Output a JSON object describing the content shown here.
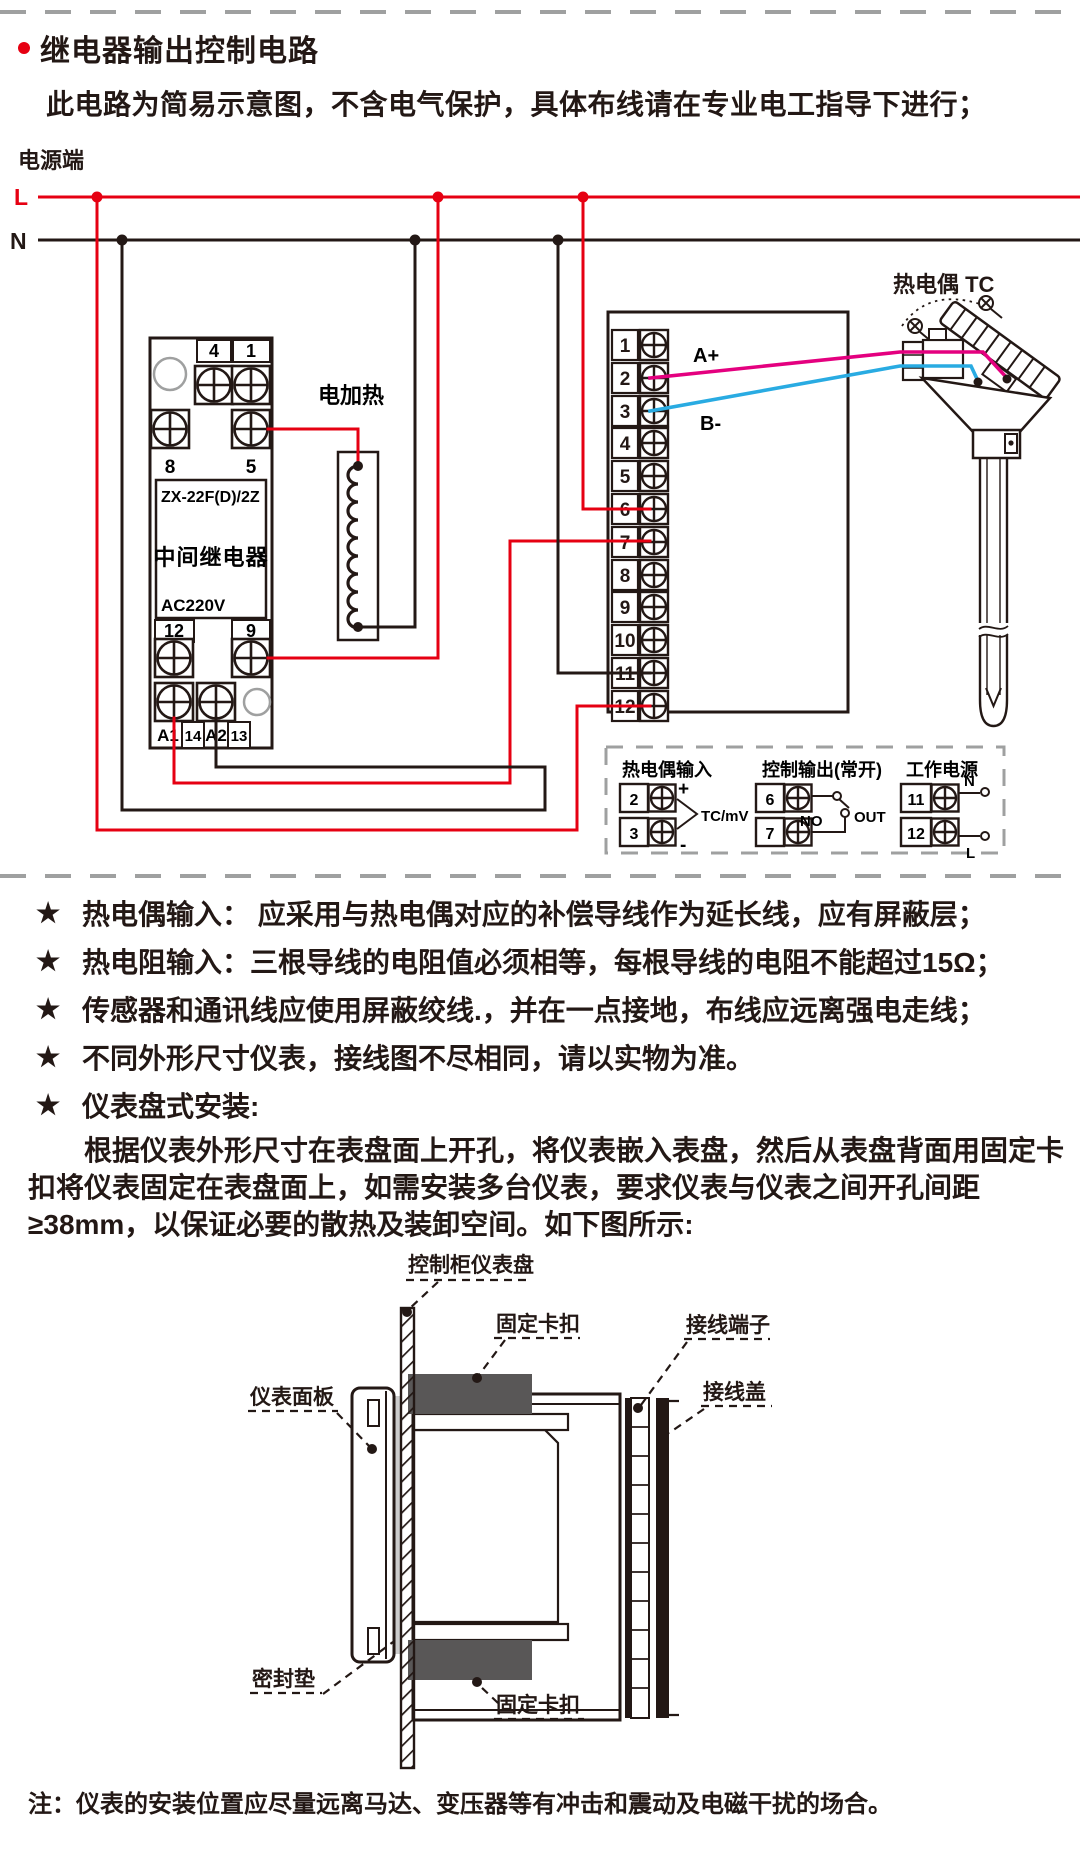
{
  "page": {
    "title": "继电器输出控制电路",
    "subtitle": "此电路为简易示意图，不含电气保护，具体布线请在专业电工指导下进行；"
  },
  "colors": {
    "wire_live": "#e60012",
    "wire_neutral": "#231815",
    "wire_tc_plus": "#e4007f",
    "wire_tc_minus": "#29abe2",
    "separator_gray": "#9fa0a0",
    "clip_fill": "#595757"
  },
  "circuit": {
    "power_label": "电源端",
    "live": "L",
    "neutral": "N",
    "heater_label": "电加热",
    "tc_label": "热电偶 TC",
    "wire_a": "A+",
    "wire_b": "B-",
    "relay": {
      "model": "ZX-22F(D)/2Z",
      "name": "中间继电器",
      "voltage": "AC220V",
      "t4": "4",
      "t1": "1",
      "t8": "8",
      "t5": "5",
      "t12": "12",
      "t9": "9",
      "a1": "A1",
      "t14": "14",
      "a2": "A2",
      "t13": "13"
    },
    "instrument": {
      "terminals": [
        "1",
        "2",
        "3",
        "4",
        "5",
        "6",
        "7",
        "8",
        "9",
        "10",
        "11",
        "12"
      ]
    },
    "legend": {
      "tc_input": {
        "title": "热电偶输入",
        "top": "2",
        "bottom": "3",
        "plus": "+",
        "minus": "-",
        "signal": "TC/mV"
      },
      "control_output": {
        "title": "控制输出(常开)",
        "top": "6",
        "bottom": "7",
        "no": "NO",
        "out": "OUT"
      },
      "power": {
        "title": "工作电源",
        "top": "11",
        "bottom": "12",
        "n": "N",
        "l": "L"
      }
    }
  },
  "notes": {
    "bullet": "★",
    "items": [
      "热电偶输入： 应采用与热电偶对应的补偿导线作为延长线，应有屏蔽层；",
      "热电阻输入：三根导线的电阻值必须相等，每根导线的电阻不能超过15Ω；",
      "传感器和通讯线应使用屏蔽绞线.，并在一点接地，布线应远离强电走线；",
      "不同外形尺寸仪表，接线图不尽相同，请以实物为准。",
      "仪表盘式安装:"
    ]
  },
  "paragraph": "根据仪表外形尺寸在表盘面上开孔，将仪表嵌入表盘，然后从表盘背面用固定卡扣将仪表固定在表盘面上，如需安装多台仪表，要求仪表与仪表之间开孔间距≥38mm，以保证必要的散热及装卸空间。如下图所示:",
  "install": {
    "labels": {
      "panel": "控制柜仪表盘",
      "clip_top": "固定卡扣",
      "terminal": "接线端子",
      "cover": "接线盖",
      "front_panel": "仪表面板",
      "gasket": "密封垫",
      "clip_bottom": "固定卡扣"
    }
  },
  "footnote": "注：仪表的安装位置应尽量远离马达、变压器等有冲击和震动及电磁干扰的场合。"
}
